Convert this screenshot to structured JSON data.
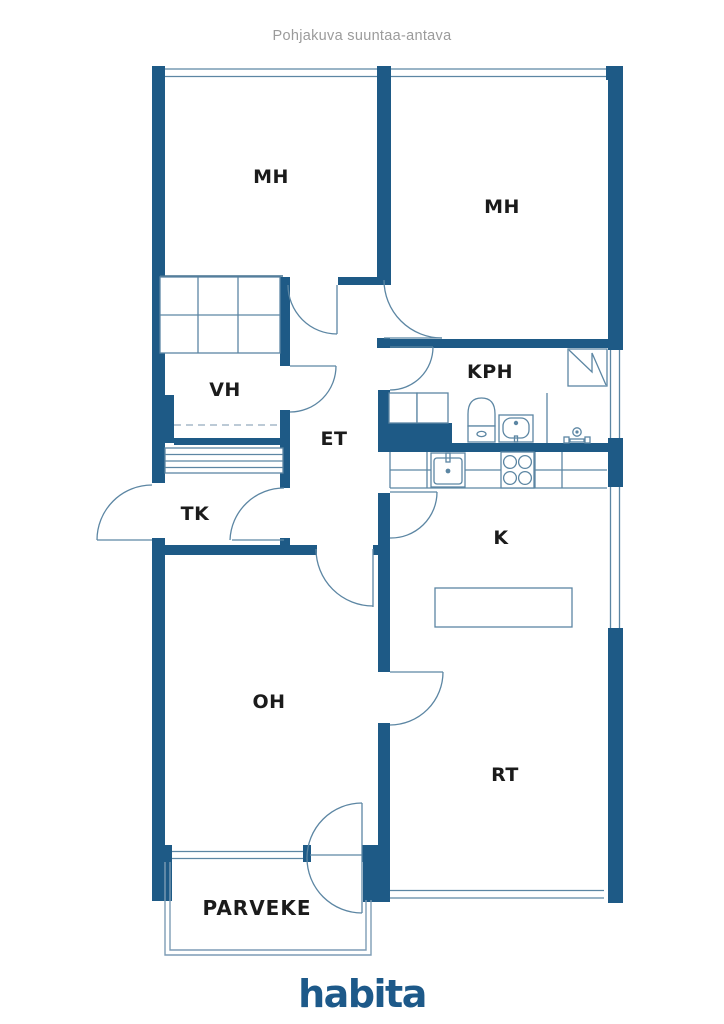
{
  "title": "Pohjakuva suuntaa-antava",
  "footer": {
    "logo_text": "habita"
  },
  "colors": {
    "wall": "#1e5a86",
    "line": "#5c86a3",
    "light_line": "#7d9cb5",
    "logo": "#1d5989",
    "title": "#9b9b9b",
    "label": "#1b1b1b"
  },
  "rooms": [
    {
      "id": "mh-left",
      "label": "MH"
    },
    {
      "id": "mh-right",
      "label": "MH"
    },
    {
      "id": "vh",
      "label": "VH"
    },
    {
      "id": "et",
      "label": "ET"
    },
    {
      "id": "kph",
      "label": "KPH"
    },
    {
      "id": "tk",
      "label": "TK"
    },
    {
      "id": "k",
      "label": "K"
    },
    {
      "id": "oh",
      "label": "OH"
    },
    {
      "id": "rt",
      "label": "RT"
    },
    {
      "id": "parveke",
      "label": "PARVEKE"
    }
  ]
}
